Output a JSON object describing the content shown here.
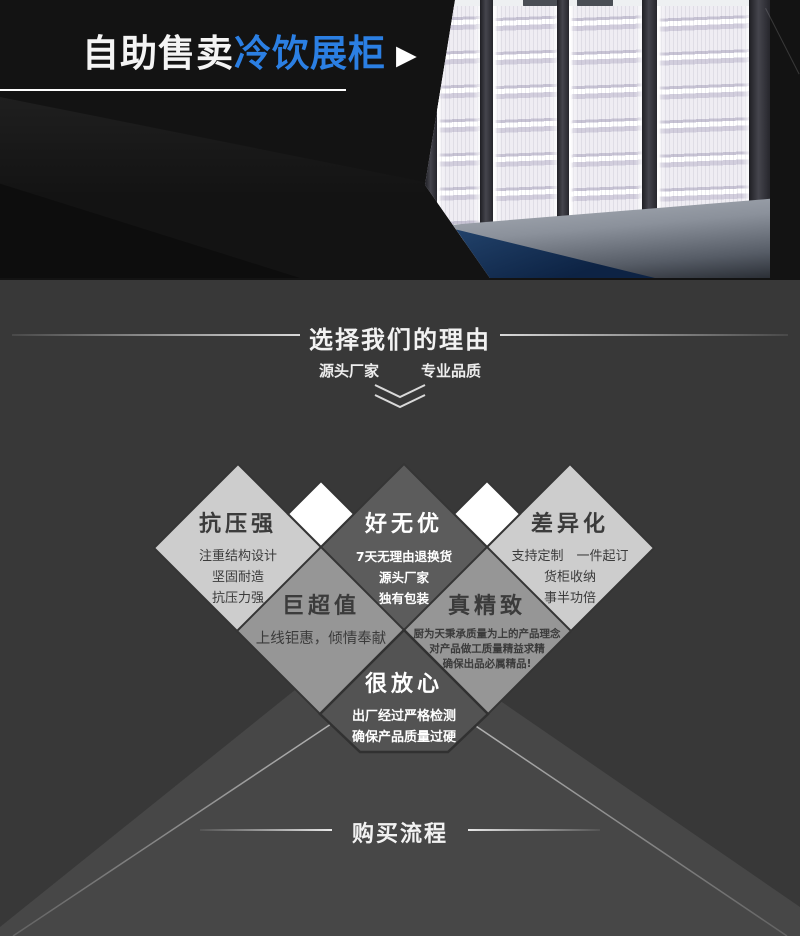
{
  "hero": {
    "title_white": "自助售卖",
    "title_blue": "冷饮展柜",
    "play_icon": "▶"
  },
  "reasons": {
    "heading": "选择我们的理由",
    "subtitle_left": "源头厂家",
    "subtitle_right": "专业品质",
    "diamonds": [
      {
        "title": "抗压强",
        "lines": [
          "注重结构设计",
          "坚固耐造",
          "抗压力强"
        ]
      },
      {
        "title": "好无优",
        "lines": [
          "7天无理由退换货",
          "源头厂家",
          "独有包装"
        ]
      },
      {
        "title": "差异化",
        "lines": [
          "支持定制　一件起订",
          "货柜收纳",
          "事半功倍"
        ]
      },
      {
        "title": "巨超值",
        "lines": [
          "上线钜惠，倾情奉献"
        ]
      },
      {
        "title": "真精致",
        "lines": [
          "厨为天秉承质量为上的产品理念",
          "对产品做工质量精益求精",
          "确保出品必属精品!"
        ]
      },
      {
        "title": "很放心",
        "lines": [
          "出厂经过严格检测",
          "确保产品质量过硬"
        ]
      }
    ]
  },
  "purchase": {
    "heading": "购买流程"
  },
  "colors": {
    "hero_bg": "#131313",
    "accent_blue": "#2b7fe3",
    "section_bg": "#383838",
    "wedge": "#474747",
    "light_diamond": "#cdcdcd",
    "medium_diamond": "#969696",
    "dark_diamond": "#5c5c5c",
    "white_diamond": "#ffffff",
    "floor_blue": "#1d3c63"
  }
}
